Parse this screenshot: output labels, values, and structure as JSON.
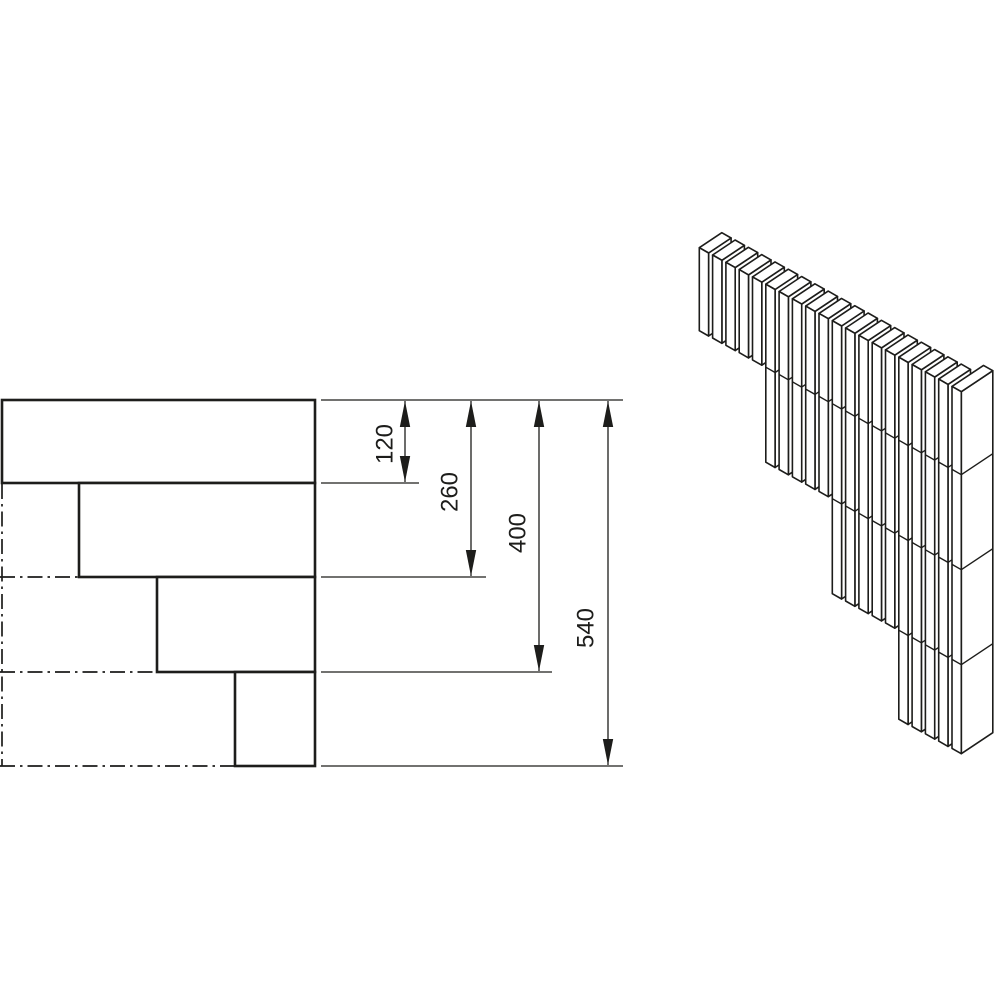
{
  "canvas": {
    "width": 1000,
    "height": 1000,
    "background": "#ffffff",
    "line_color": "#1d1d1b"
  },
  "front_view": {
    "description": "front-elevation-of-stepped-slat-corner",
    "right_edge_x": 315,
    "hatch_spacing": 9.35,
    "rows": [
      {
        "x": 2,
        "y": 400,
        "width": 313,
        "height": 83
      },
      {
        "x": 79,
        "y": 483,
        "width": 236,
        "height": 94
      },
      {
        "x": 157,
        "y": 577,
        "width": 158,
        "height": 95
      },
      {
        "x": 235,
        "y": 672,
        "width": 80,
        "height": 94
      }
    ],
    "centerlines": [
      {
        "x1": 2,
        "y1": 484,
        "x2": 2,
        "y2": 766
      },
      {
        "x1": 0,
        "y1": 577,
        "x2": 78,
        "y2": 577
      },
      {
        "x1": 0,
        "y1": 672,
        "x2": 156,
        "y2": 672
      },
      {
        "x1": 0,
        "y1": 766,
        "x2": 234,
        "y2": 766
      }
    ]
  },
  "dimensions": {
    "baseline_y": 400,
    "ext_x_start": 321,
    "top_extension": {
      "y": 400,
      "x1": 321,
      "x2": 623
    },
    "arrow": {
      "length": 26,
      "half_width": 5.2
    },
    "items": [
      {
        "label": "120",
        "value": 120,
        "line_x": 405,
        "y_end": 483,
        "ext_x_end": 419,
        "label_x": 386,
        "label_y": 444
      },
      {
        "label": "260",
        "value": 260,
        "line_x": 471,
        "y_end": 577,
        "ext_x_end": 486,
        "label_x": 451,
        "label_y": 492
      },
      {
        "label": "400",
        "value": 400,
        "line_x": 539,
        "y_end": 672,
        "ext_x_end": 552,
        "label_x": 519,
        "label_y": 533
      },
      {
        "label": "540",
        "value": 540,
        "line_x": 608,
        "y_end": 766,
        "ext_x_end": 623,
        "label_x": 587,
        "label_y": 628
      }
    ]
  },
  "iso_view": {
    "description": "isometric-view-of-stepped-slat-corner",
    "origin": {
      "x": 699.3,
      "y": 247.7
    },
    "pitch": {
      "x": 13.3,
      "y": 7.3
    },
    "slat_width": {
      "x": 9.3,
      "y": 5.3
    },
    "depth": {
      "x": 22.5,
      "y": -15
    },
    "end_depth": {
      "x": 31.5,
      "y": -21
    },
    "groups": [
      {
        "count": 5,
        "height": 83
      },
      {
        "count": 5,
        "height": 178
      },
      {
        "count": 5,
        "height": 273
      },
      {
        "count": 5,
        "height": 362
      }
    ],
    "joint_heights": [
      83,
      178,
      273
    ]
  }
}
